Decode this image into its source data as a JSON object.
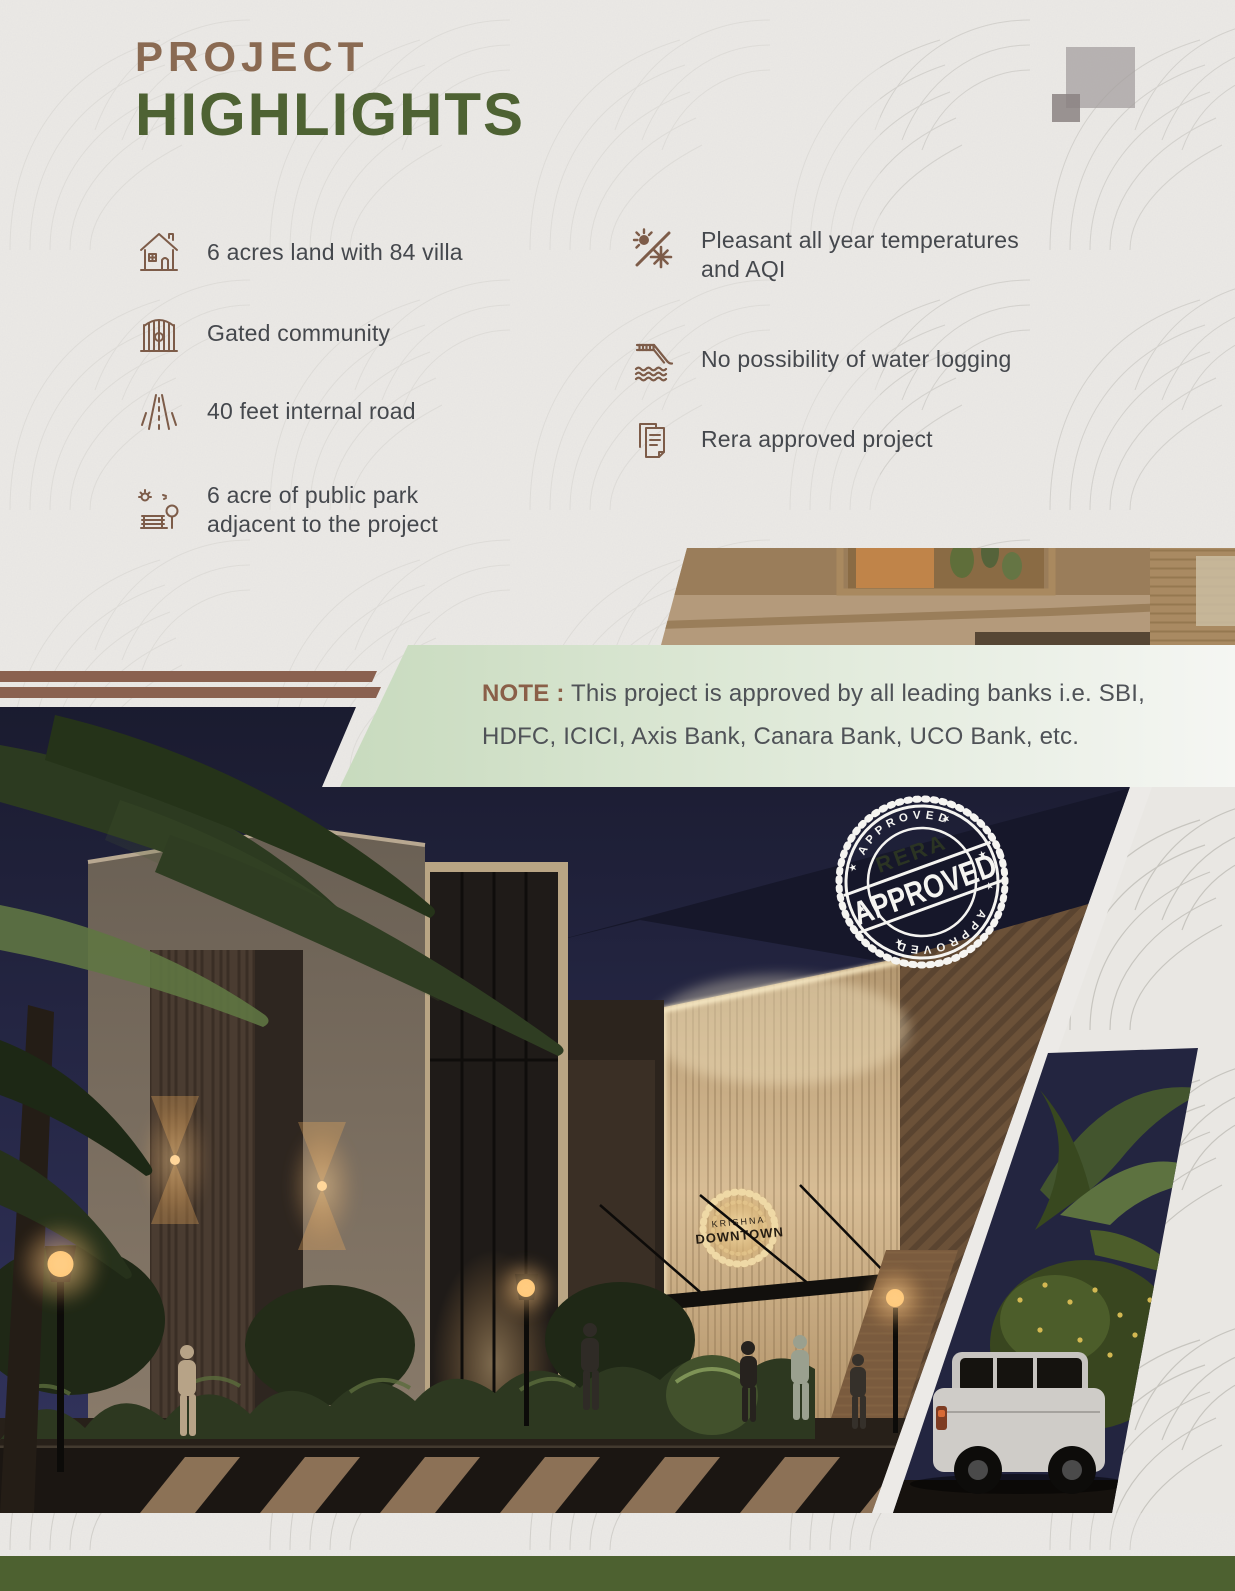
{
  "header": {
    "title_line1": "PROJECT",
    "title_line2": "HIGHLIGHTS"
  },
  "highlights": {
    "left": [
      {
        "icon": "house-villa-icon",
        "text": "6 acres land with 84 villa"
      },
      {
        "icon": "gate-icon",
        "text": "Gated community"
      },
      {
        "icon": "road-icon",
        "text": "40 feet internal road"
      },
      {
        "icon": "park-icon",
        "text": "6 acre of public park adjacent to the project"
      }
    ],
    "right": [
      {
        "icon": "climate-icon",
        "text": "Pleasant all year temperatures and AQI"
      },
      {
        "icon": "water-logging-icon",
        "text": "No possibility of water logging"
      },
      {
        "icon": "rera-document-icon",
        "text": "Rera approved project"
      }
    ]
  },
  "note": {
    "label": "NOTE :",
    "line1": "This project is approved by all leading banks i.e. SBI,",
    "line2": "HDFC, ICICI, Axis Bank, Canara Bank, UCO Bank, etc."
  },
  "stamp": {
    "arc_top": "APPROVED",
    "name": "RERA",
    "main": "APPROVED",
    "arc_bottom": "APPROVED"
  },
  "building_sign": {
    "line1": "KRISHNA",
    "line2": "DOWNTOWN"
  },
  "colors": {
    "title_brown": "#8a6a52",
    "title_green": "#4e6233",
    "icon_brown": "#7d5c49",
    "stripe_brown": "#8a6150",
    "note_green": "#cbdcc2",
    "footer_green": "#4d6130",
    "sky_navy": "#23253f",
    "paper": "#ebe9e6"
  }
}
